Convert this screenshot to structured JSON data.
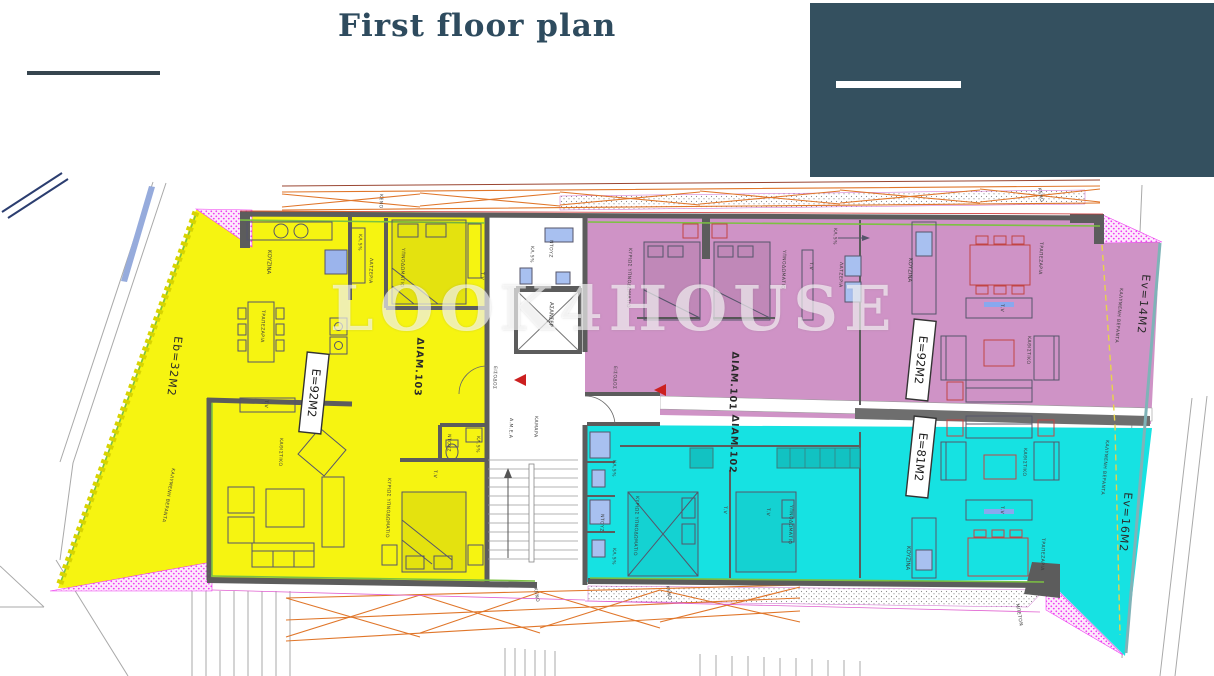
{
  "header": {
    "title": "First floor plan"
  },
  "watermark": {
    "text": "LOOK4HOUSE"
  },
  "colors": {
    "navy": "#34505f",
    "title": "#2e4b5e",
    "yellow": "#f6f411",
    "pink": "#cf93c6",
    "cyan": "#16e2e2",
    "hatch_dot": "#ee3ff0",
    "wall": "#5c5c5c",
    "orange": "#e0762a",
    "green": "#7cc142",
    "red_arrow": "#cc2020"
  },
  "plan": {
    "apartments": [
      {
        "name": "ΔΙΑΜ.103",
        "area": "E=92M2",
        "outdoor_area": "Eb=32M2",
        "outdoor_label": "ΚΑΛΥΜΕΝΗ ΒΕΡΑΝΤΑ"
      },
      {
        "name": "ΔΙΑΜ.101",
        "area": "E=92M2",
        "outdoor_area": "Ev=14M2",
        "outdoor_label": "ΚΑΛΥΜΕΝΗ ΒΕΡΑΝΤΑ"
      },
      {
        "name": "ΔΙΑΜ.102",
        "area": "E=81M2",
        "outdoor_area": "Ev=16M2",
        "outdoor_label": "ΚΑΛΥΜΕΝΗ ΒΕΡΑΝΤΑ"
      }
    ],
    "rooms": {
      "kitchen": "ΚΟΥΖΙΝΑ",
      "dining": "ΤΡΑΠΕΖΑΡΙΑ",
      "living": "ΚΑΘΙΣΤΙΚΟ",
      "bedroom": "ΥΠΝΟΔΩΜΑΤΙΟ",
      "master_bedroom": "ΚΥΡΙΩΣ ΥΠΝΟΔΩΜΑΤΙΟ",
      "shower": "ΝΤΟΥΖ",
      "tv": "T.V",
      "slope": "ΚΛ.5%",
      "utility": "ΛΑΤΖΕΡΙΑ",
      "entrance": "ΕΙΣΟΔΟΣ",
      "elevator": "ΑΣΑΝΣΕΡ",
      "lobby": "ΚΑΜΑΡΑ",
      "accessible": "Α.Μ.Ε.Α",
      "void": "ΚΕΝΟ",
      "concrete": "ΜΠΕΤΟΝ"
    }
  }
}
